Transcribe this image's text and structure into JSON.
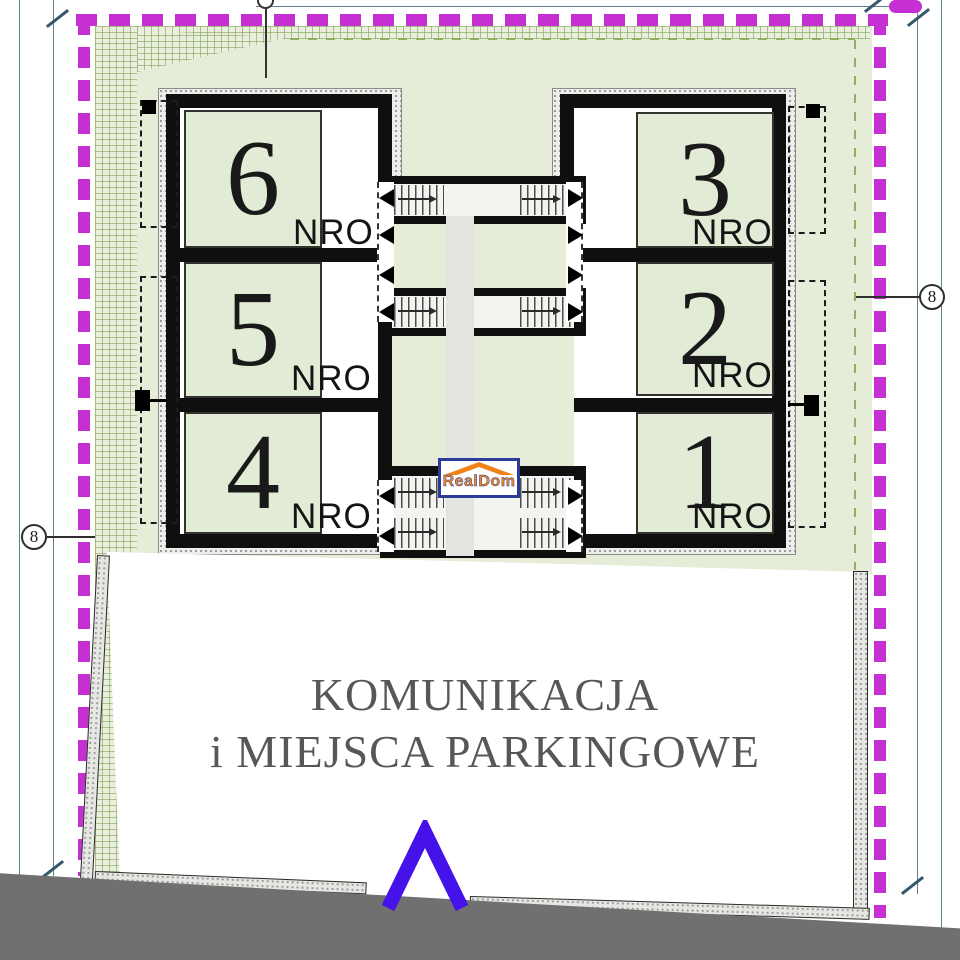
{
  "plan": {
    "title": "building site plan",
    "boundary_color": "#c62fd2",
    "site_color": "#e5ecd7",
    "room_color": "#e2ebd5",
    "road_color": "#707070",
    "entrance_arrow_color": "#4513ea",
    "units": [
      {
        "number": "6",
        "suite_label": "NRO"
      },
      {
        "number": "5",
        "suite_label": "NRO"
      },
      {
        "number": "4",
        "suite_label": "NRO"
      },
      {
        "number": "3",
        "suite_label": "NRO"
      },
      {
        "number": "2",
        "suite_label": "NRO"
      },
      {
        "number": "1",
        "suite_label": "NRO"
      }
    ],
    "parking_area": {
      "line1": "KOMUNIKACJA",
      "line2": "i MIEJSCA PARKINGOWE"
    },
    "survey_points": {
      "left": "8",
      "right": "8"
    },
    "watermark": {
      "text": "RealDom"
    }
  }
}
